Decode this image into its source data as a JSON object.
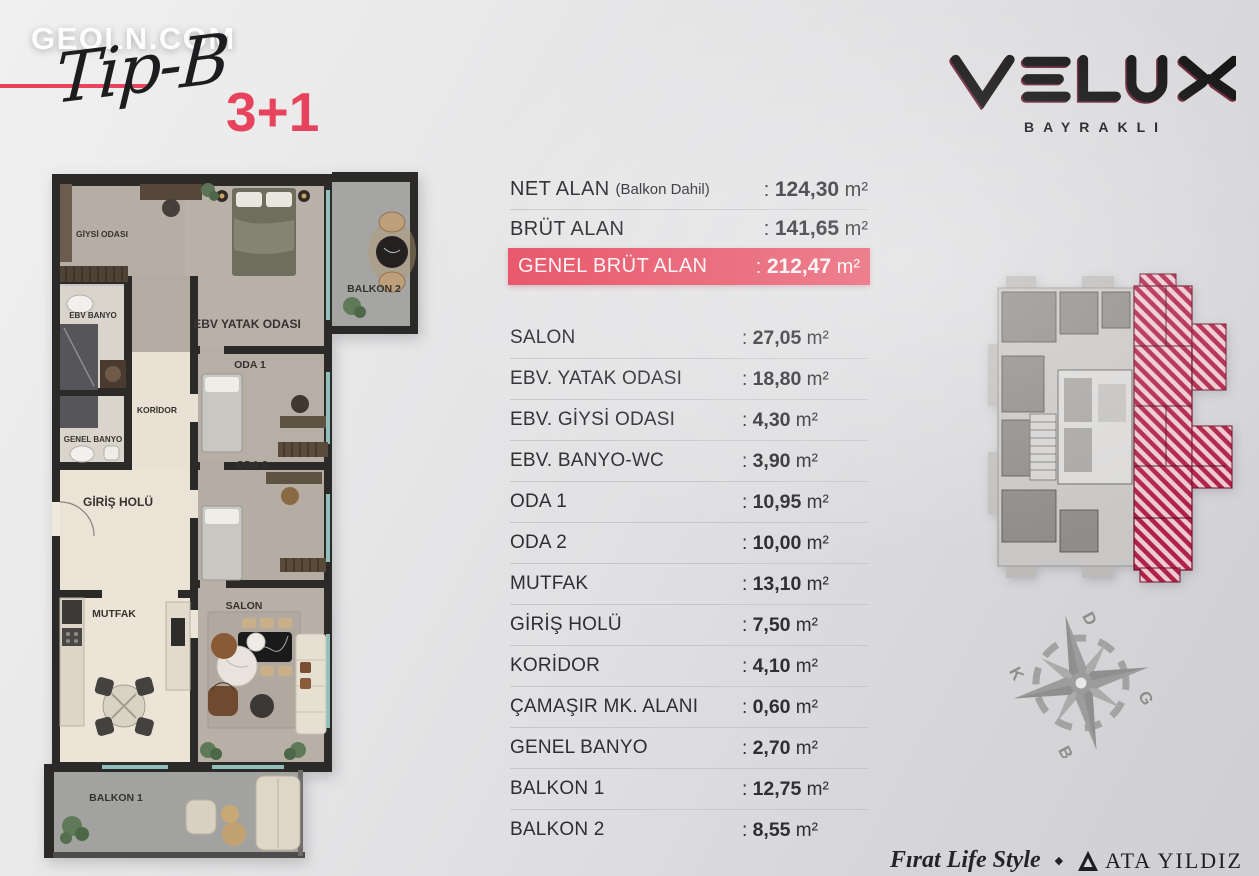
{
  "punct": {
    "colon": ":",
    "separator": "◆"
  },
  "units": {
    "area": "m²"
  },
  "watermark": "GEOLN.COM",
  "header": {
    "type_script": "Tip-B",
    "rooms_badge": "3+1"
  },
  "brand": {
    "name": "VELUX",
    "subtitle": "BAYRAKLI"
  },
  "summary": [
    {
      "label": "NET ALAN",
      "note": "(Balkon Dahil)",
      "value": "124,30",
      "unit": "m²"
    },
    {
      "label": "BRÜT ALAN",
      "note": "",
      "value": "141,65",
      "unit": "m²"
    },
    {
      "label": "GENEL BRÜT ALAN",
      "note": "",
      "value": "212,47",
      "unit": "m²"
    }
  ],
  "rooms": [
    {
      "label": "SALON",
      "value": "27,05"
    },
    {
      "label": "EBV. YATAK ODASI",
      "value": "18,80"
    },
    {
      "label": "EBV. GİYSİ ODASI",
      "value": "4,30"
    },
    {
      "label": "EBV. BANYO-WC",
      "value": "3,90"
    },
    {
      "label": "ODA 1",
      "value": "10,95"
    },
    {
      "label": "ODA 2",
      "value": "10,00"
    },
    {
      "label": "MUTFAK",
      "value": "13,10"
    },
    {
      "label": "GİRİŞ HOLÜ",
      "value": "7,50"
    },
    {
      "label": "KORİDOR",
      "value": "4,10"
    },
    {
      "label": "ÇAMAŞIR MK. ALANI",
      "value": "0,60"
    },
    {
      "label": "GENEL BANYO",
      "value": "2,70"
    },
    {
      "label": "BALKON 1",
      "value": "12,75"
    },
    {
      "label": "BALKON 2",
      "value": "8,55"
    }
  ],
  "floorplan": {
    "labels": {
      "giysi": "GİYSİ ODASI",
      "yatak": "EBV YATAK ODASI",
      "balkon2": "BALKON 2",
      "ebv_banyo": "EBV BANYO",
      "koridor": "KORİDOR",
      "genel_banyo": "GENEL BANYO",
      "giris": "GİRİŞ HOLÜ",
      "oda1": "ODA 1",
      "oda2": "ODA 2",
      "mutfak": "MUTFAK",
      "salon": "SALON",
      "balkon1": "BALKON 1"
    }
  },
  "compass": {
    "d": "D",
    "k": "K",
    "g": "G",
    "b": "B"
  },
  "footer": {
    "left_brand": "Fırat Life Style",
    "right_brand": "ATA YILDIZ"
  },
  "colors": {
    "accent": "#e8435c",
    "highlight_bar": "#e64f63",
    "hatch_dark": "#b02348",
    "hatch_light": "#edc9d1"
  }
}
